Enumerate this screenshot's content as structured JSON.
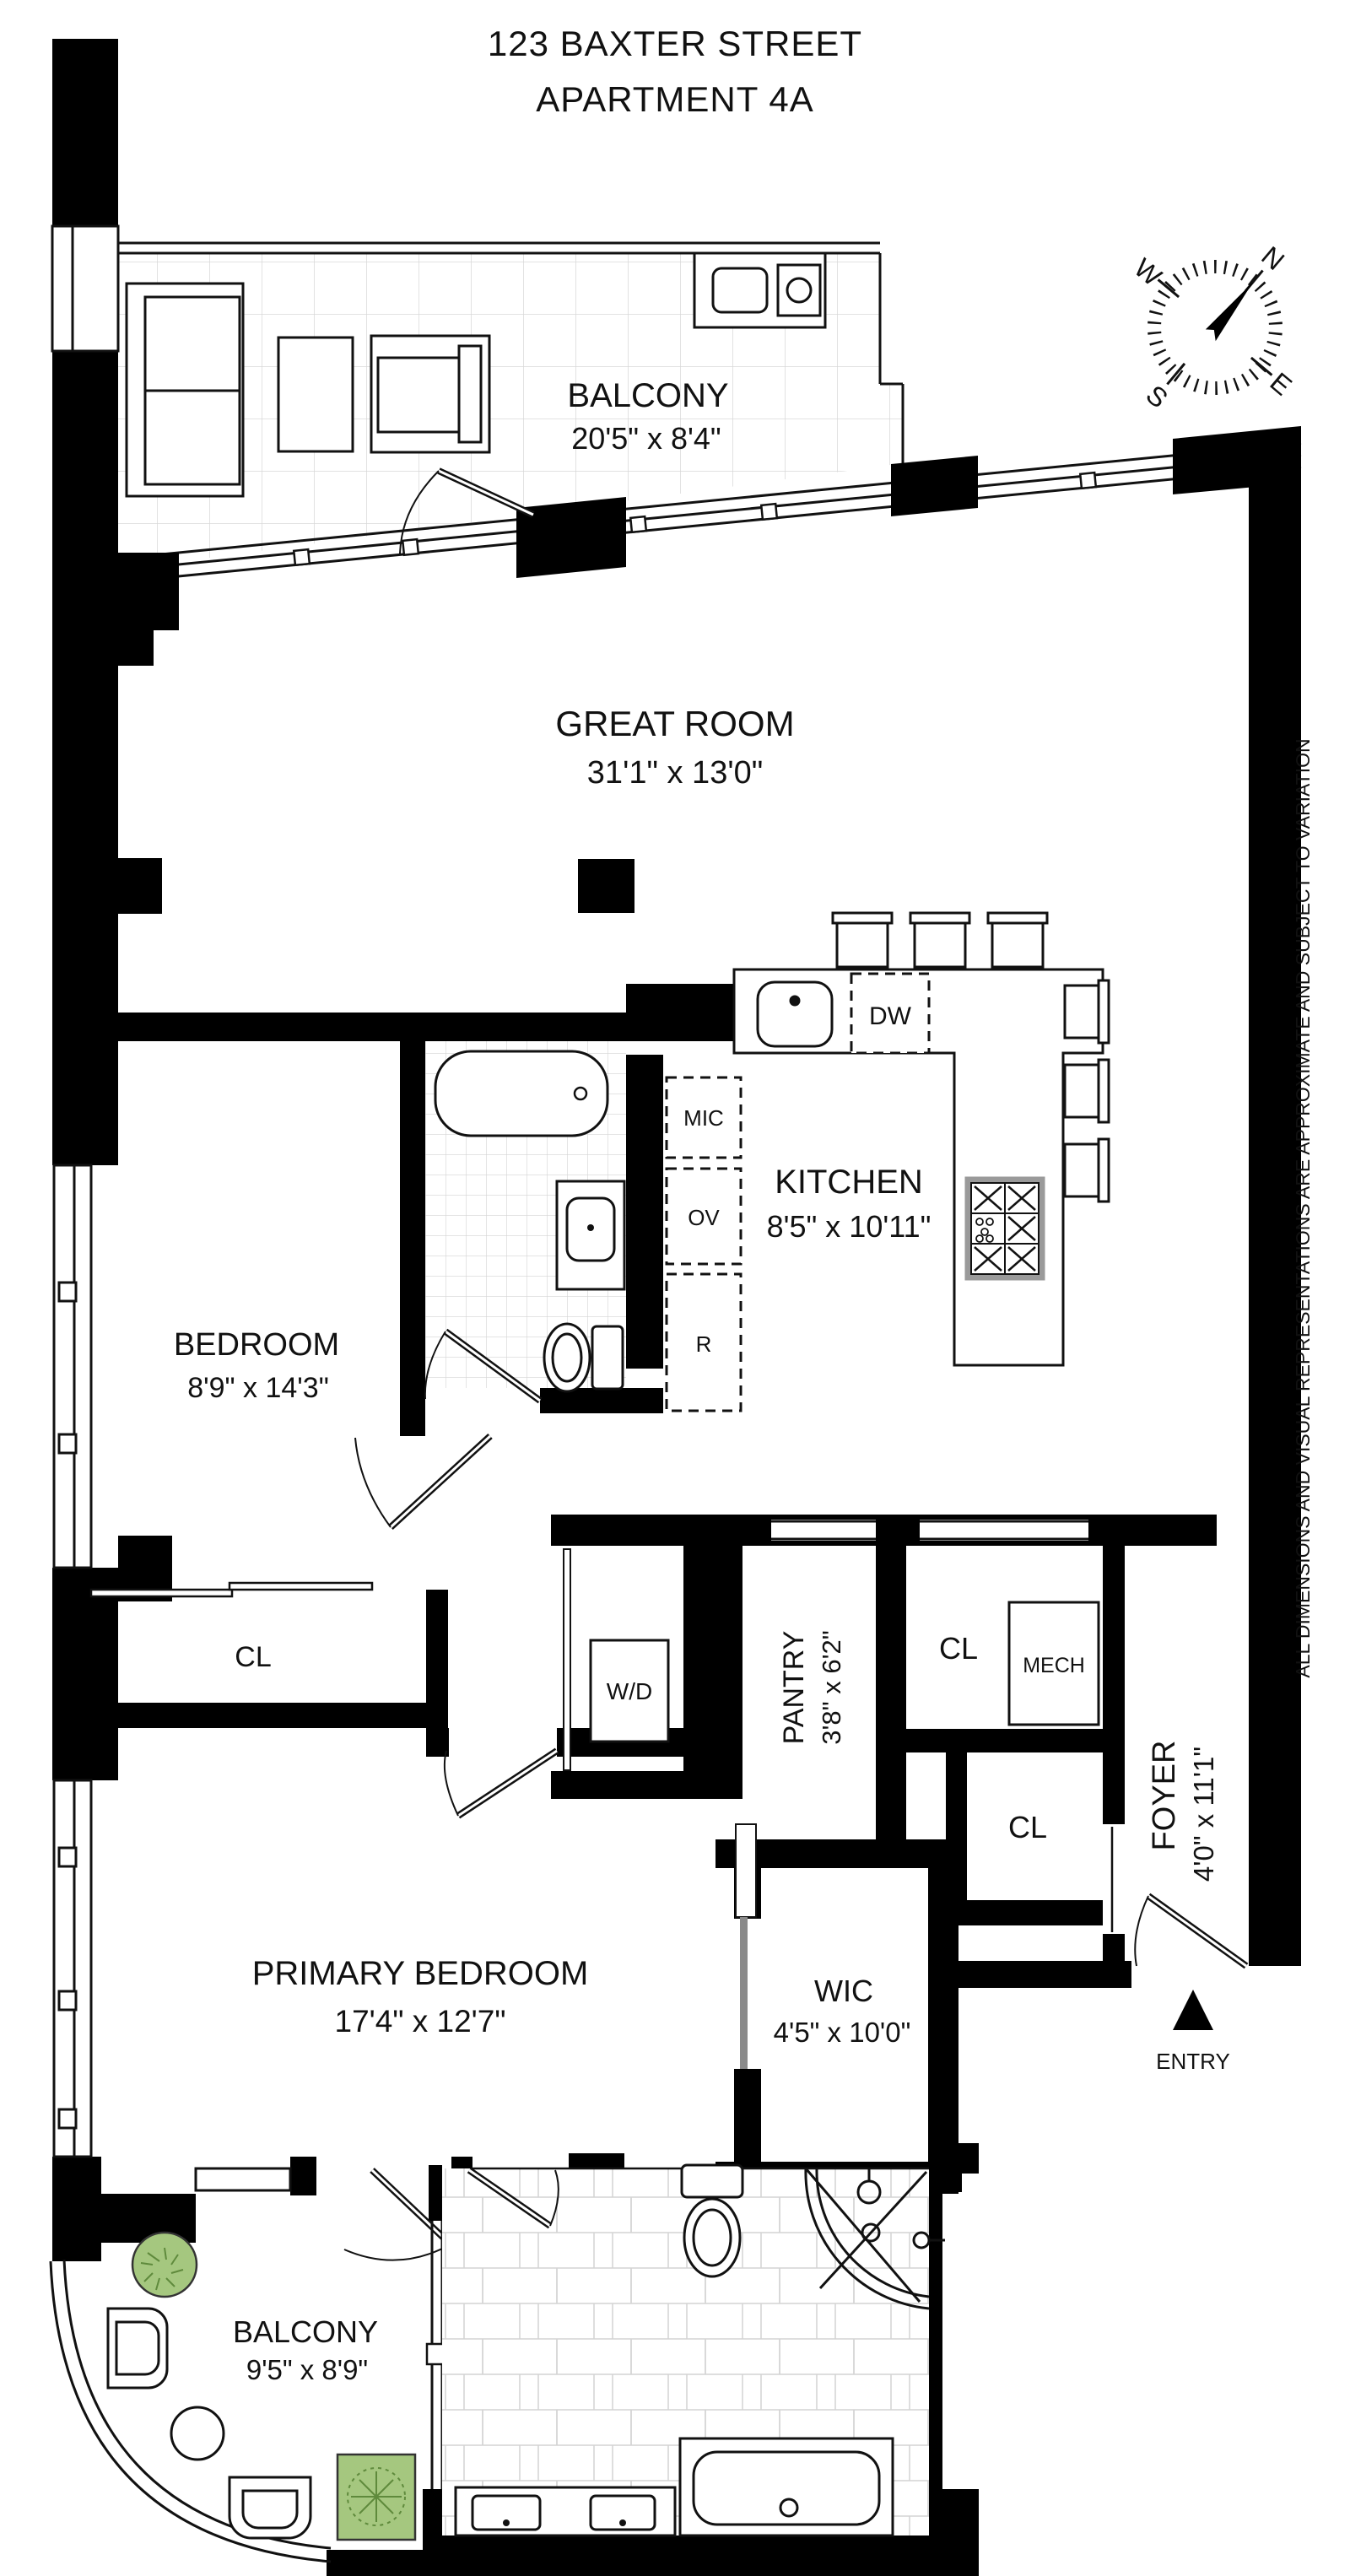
{
  "title": {
    "line1": "123 BAXTER STREET",
    "line2": "APARTMENT 4A"
  },
  "rooms": {
    "balcony_top": {
      "name": "BALCONY",
      "dims": "20'5\" x 8'4\""
    },
    "great_room": {
      "name": "GREAT ROOM",
      "dims": "31'1\" x 13'0\""
    },
    "bedroom": {
      "name": "BEDROOM",
      "dims": "8'9\" x 14'3\""
    },
    "kitchen": {
      "name": "KITCHEN",
      "dims": "8'5\" x 10'11\""
    },
    "pantry": {
      "name": "PANTRY",
      "dims": "3'8\" x 6'2\""
    },
    "foyer": {
      "name": "FOYER",
      "dims": "4'0\" x 11'1\""
    },
    "primary_bedroom": {
      "name": "PRIMARY BEDROOM",
      "dims": "17'4\" x 12'7\""
    },
    "wic": {
      "name": "WIC",
      "dims": "4'5\" x 10'0\""
    },
    "balcony_bottom": {
      "name": "BALCONY",
      "dims": "9'5\" x 8'9\""
    }
  },
  "fixtures": {
    "dishwasher": "DW",
    "microwave": "MIC",
    "oven": "OV",
    "refrigerator": "R",
    "washer_dryer": "W/D",
    "closet_bedroom": "CL",
    "closet_mech_room": "CL",
    "mech": "MECH",
    "closet_foyer": "CL",
    "entry": "ENTRY"
  },
  "compass": {
    "n": "N",
    "e": "E",
    "s": "S",
    "w": "W"
  },
  "disclaimer": "ALL DIMENSIONS AND VISUAL REPRESENTATIONS ARE APPROXIMATE AND SUBJECT TO VARIATION",
  "colors": {
    "wall": "#000000",
    "line": "#1a1a1a",
    "plant_fill": "#a5c77f",
    "plant_stroke": "#5f8a3c",
    "tile_line": "#cfcfcf",
    "pocket_door": "#8a8a8a"
  }
}
